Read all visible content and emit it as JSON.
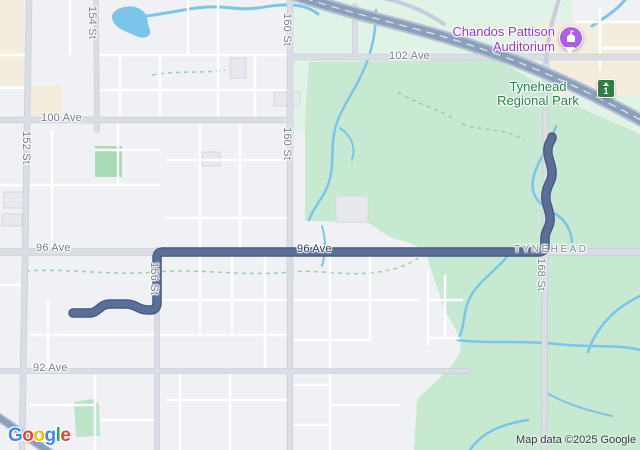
{
  "colors": {
    "route": "#5B6E98",
    "route_casing": "#44567D",
    "park_green": "#C7E8D1",
    "park_green_pale": "#E1F2E6",
    "park_green_accent": "#A8DCB6",
    "water_blue": "#7CC5EA",
    "highway": "#8CA0BB",
    "highway_casing": "#B6C2D4",
    "beige": "#F2EDDD",
    "poi_purple": "#9A3DC9",
    "park_label_green": "#1F8746",
    "shield_green": "#2B7D44",
    "pin_purple": "#AC5FE6"
  },
  "streets": {
    "ave_100": "100 Ave",
    "ave_102": "102 Ave",
    "ave_96_left": "96 Ave",
    "ave_96_on_route": "96 Ave",
    "ave_92": "92 Ave",
    "st_152": "152 St",
    "st_154": "154 St",
    "st_156": "156 St",
    "st_160_top": "160 St",
    "st_160_mid": "160 St",
    "st_168": "168 St",
    "tynehead_road": "TYNEHEAD"
  },
  "poi": {
    "auditorium_line1": "Chandos Pattison",
    "auditorium_line2": "Auditorium",
    "park_line1": "Tynehead",
    "park_line2": "Regional Park",
    "highway_shield_number": "1"
  },
  "footer": {
    "logo_letters": [
      {
        "ch": "G",
        "color": "#4285F4"
      },
      {
        "ch": "o",
        "color": "#EA4335"
      },
      {
        "ch": "o",
        "color": "#FBBC05"
      },
      {
        "ch": "g",
        "color": "#4285F4"
      },
      {
        "ch": "l",
        "color": "#34A853"
      },
      {
        "ch": "e",
        "color": "#EA4335"
      }
    ],
    "attribution": "Map data ©2025 Google"
  }
}
